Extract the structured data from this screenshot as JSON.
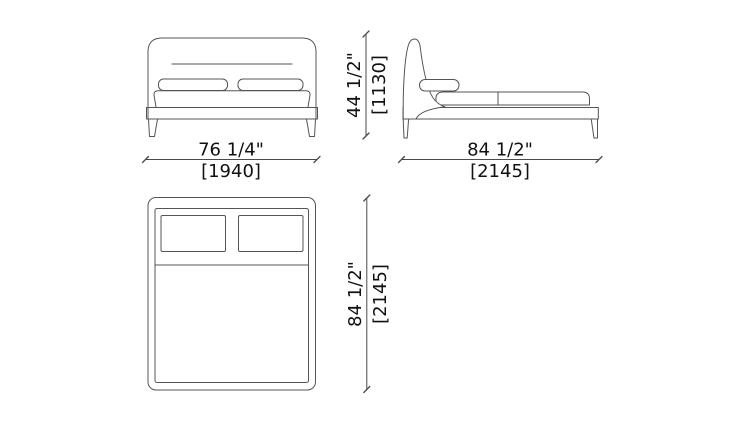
{
  "drawing": {
    "subject": "bed",
    "views": [
      "front-elevation",
      "side-elevation",
      "plan-view"
    ]
  },
  "dimensions": {
    "front_width": {
      "inches": "76 1/4\"",
      "mm": "[1940]"
    },
    "bed_height": {
      "inches": "44 1/2\"",
      "mm": "[1130]"
    },
    "side_depth": {
      "inches": "84 1/2\"",
      "mm": "[2145]"
    },
    "plan_depth": {
      "inches": "84 1/2\"",
      "mm": "[2145]"
    }
  },
  "colors": {
    "background": "#ffffff",
    "drawing_line": "#555555",
    "dimension_line": "#4a4a4a",
    "dimension_text": "#111111"
  }
}
